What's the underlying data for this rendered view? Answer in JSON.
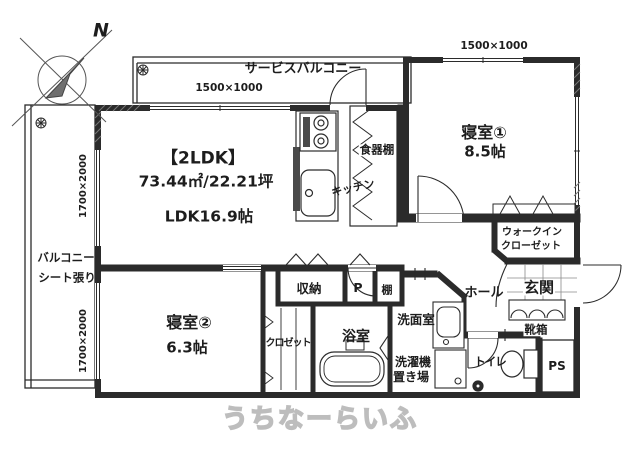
{
  "watermark": "うちなーらいふ",
  "compass": {
    "north_label": "N"
  },
  "plan": {
    "type_label": "【2LDK】",
    "area_label": "73.44㎡/22.21坪",
    "ldk_label": "LDK16.9帖",
    "rooms": {
      "bedroom1": {
        "name": "寝室①",
        "size": "8.5帖"
      },
      "bedroom2": {
        "name": "寝室②",
        "size": "6.3帖"
      },
      "kitchen": "キッチン",
      "bath": "浴室",
      "washroom": "洗面室",
      "toilet": "トイレ",
      "hall": "ホール",
      "entrance": "玄関",
      "wic_line1": "ウォークイン",
      "wic_line2": "クローゼット",
      "service_balcony": "サービスバルコニー",
      "balcony_line1": "バルコニー",
      "balcony_line2": "シート張り"
    },
    "fixtures": {
      "storage": "収納",
      "pipe_small": "P",
      "shelf": "棚",
      "closet": "クロゼット",
      "cupboard": "食器棚",
      "laundry_line1": "洗濯機",
      "laundry_line2": "置き場",
      "shoebox": "靴箱",
      "pipe_space": "PS"
    },
    "dimensions": {
      "service_balcony_window": "1500×1000",
      "bedroom1_window": "1500×1000",
      "balcony_window_upper": "1700×2000",
      "balcony_window_lower": "1700×2000"
    }
  },
  "colors": {
    "line": "#2b2b2b",
    "watermark": "#bdbdbd",
    "background": "#ffffff"
  }
}
